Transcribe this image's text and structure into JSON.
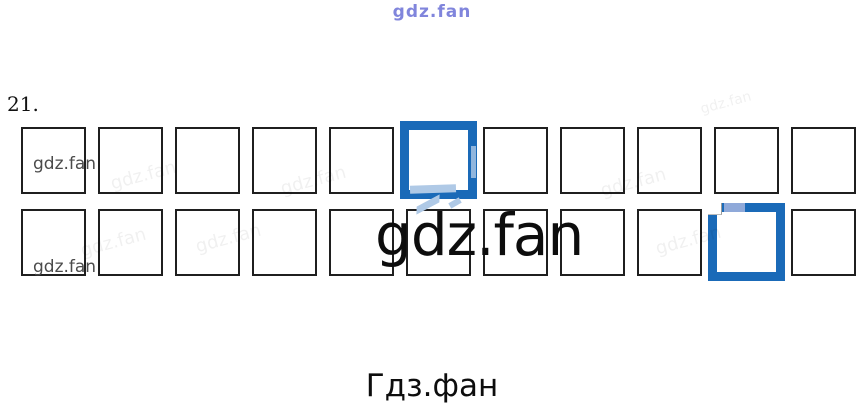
{
  "watermarks": {
    "top": "gdz.fan",
    "tile": "gdz.fan",
    "big": "gdz.fan",
    "bottom": "Гдз.фан",
    "row1_label": "gdz.fan",
    "row2_label": "gdz.fan"
  },
  "exercise": {
    "number": "21."
  },
  "grid": {
    "rows": [
      {
        "cell_count": 11,
        "highlighted_cell": 6
      },
      {
        "cell_count": 11,
        "highlighted_cell": 10
      }
    ]
  },
  "colors": {
    "highlight-blue": "#1a6ab8",
    "light-blue": "#8fa9d9",
    "pale-blue": "#afc9e6",
    "border-dark": "#1f1f1f",
    "watermark-gray": "#4b4b4b",
    "top-watermark-blue": "#6b70d6"
  }
}
